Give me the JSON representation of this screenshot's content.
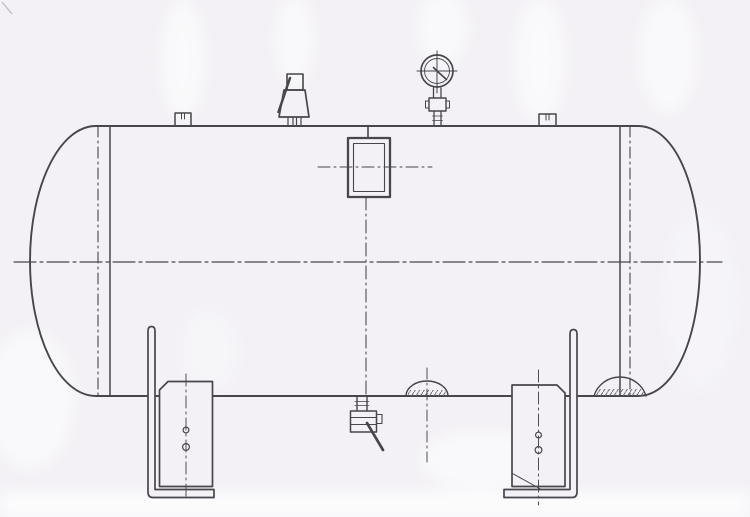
{
  "meta": {
    "title": "Horizontal pressure vessel - side elevation engineering drawing (scanned, no text)",
    "drawing_style": "black line technical drawing on scanned paper",
    "visible_text": "none"
  },
  "colors": {
    "paper": "#f3f1f5",
    "line": "#46464c",
    "thin_line": "#5a5a61",
    "hatch": "#63636b",
    "ghost": "#ffffff"
  },
  "components": {
    "tank_shell": "horizontal cylindrical shell with elliptical heads",
    "left_head_seam": "left head-to-shell weld seam (solid) with tangent centerline (dash-dot)",
    "right_head_seam": "right head-to-shell weld seam (solid) with tangent centerline (dash-dot)",
    "main_centerline": "horizontal dash-dot vessel centerline",
    "vertical_centerline": "vertical dash-dot centerline from manhole to drain",
    "manhole": "rectangular manhole cover with inner frame and cross centerlines",
    "safety_valve": "lever-type safety relief valve on top nozzle",
    "pressure_gauge": "dial pressure gauge with needle on gauge cock",
    "nozzle_left": "small capped nozzle stub on shell top",
    "nozzle_right": "small capped nozzle stub on shell top",
    "drain_valve": "bottom drain valve with diagonal lever handle",
    "boss_small": "small hatched reinforcement boss on shell bottom",
    "boss_large": "large hatched sump boss at right bottom seam",
    "left_support": "left L-bracket saddle support with base foot, saddle plate, chamfer and two bolt holes",
    "right_support": "right L-bracket saddle support with base foot, saddle plate, chamfer, gusset line and two bolt holes"
  }
}
